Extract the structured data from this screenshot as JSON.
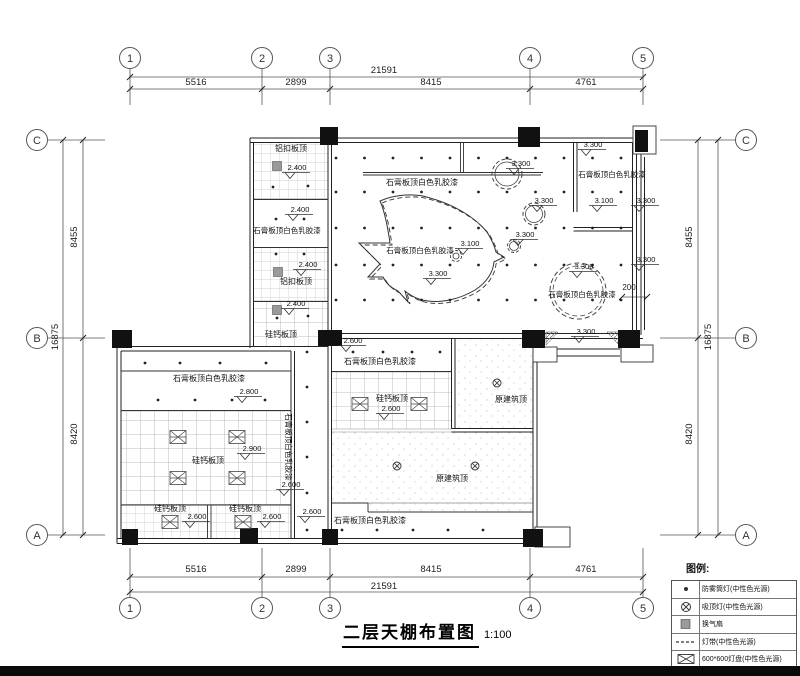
{
  "title": {
    "text": "二层天棚布置图",
    "scale": "1:100"
  },
  "legend": {
    "title": "图例:",
    "items": [
      {
        "symbol": "downlight-dot",
        "label": "防雾筒灯(中性色光源)"
      },
      {
        "symbol": "ceiling-lamp",
        "label": "吸顶灯(中性色光源)"
      },
      {
        "symbol": "exhaust-fan",
        "label": "换气扇"
      },
      {
        "symbol": "light-strip",
        "label": "灯带(中性色光源)"
      },
      {
        "symbol": "panel-light",
        "label": "600*600灯盘(中性色光源)"
      }
    ]
  },
  "grid": {
    "cols": [
      {
        "id": "1",
        "x": 130
      },
      {
        "id": "2",
        "x": 262
      },
      {
        "id": "3",
        "x": 330
      },
      {
        "id": "4",
        "x": 530
      },
      {
        "id": "5",
        "x": 643
      }
    ],
    "rows": [
      {
        "id": "C",
        "y": 140
      },
      {
        "id": "B",
        "y": 338
      },
      {
        "id": "A",
        "y": 535
      }
    ],
    "dims": [
      {
        "t": "21591",
        "x": 384,
        "y": 73
      },
      {
        "t": "5516",
        "x": 196,
        "y": 85
      },
      {
        "t": "2899",
        "x": 296,
        "y": 85
      },
      {
        "t": "8415",
        "x": 431,
        "y": 85
      },
      {
        "t": "4761",
        "x": 586,
        "y": 85
      },
      {
        "t": "5516",
        "x": 196,
        "y": 572
      },
      {
        "t": "2899",
        "x": 296,
        "y": 572
      },
      {
        "t": "8415",
        "x": 431,
        "y": 572
      },
      {
        "t": "4761",
        "x": 586,
        "y": 572
      },
      {
        "t": "21591",
        "x": 384,
        "y": 589
      },
      {
        "t": "8455",
        "x": 77,
        "y": 237,
        "r": -90
      },
      {
        "t": "8420",
        "x": 77,
        "y": 434,
        "r": -90
      },
      {
        "t": "16875",
        "x": 58,
        "y": 337,
        "r": -90
      },
      {
        "t": "8455",
        "x": 692,
        "y": 237,
        "r": -90
      },
      {
        "t": "8420",
        "x": 692,
        "y": 434,
        "r": -90
      },
      {
        "t": "16875",
        "x": 711,
        "y": 337,
        "r": -90
      },
      {
        "t": "200",
        "x": 629,
        "y": 290,
        "s": 8
      }
    ]
  },
  "plan": {
    "labels": [
      {
        "t": "铝扣板顶",
        "x": 291,
        "y": 151
      },
      {
        "t": "石膏板顶白色乳胶漆",
        "x": 287,
        "y": 233,
        "s": 7.5
      },
      {
        "t": "铝扣板顶",
        "x": 296,
        "y": 284
      },
      {
        "t": "硅钙板顶",
        "x": 281,
        "y": 337
      },
      {
        "t": "石膏板顶白色乳胶漆",
        "x": 422,
        "y": 185
      },
      {
        "t": "石膏板顶白色乳胶漆",
        "x": 420,
        "y": 253,
        "s": 7.5
      },
      {
        "t": "石膏板顶白色乳胶漆",
        "x": 612,
        "y": 177,
        "s": 7.5
      },
      {
        "t": "石膏板顶白色乳胶漆",
        "x": 582,
        "y": 297,
        "s": 7.5
      },
      {
        "t": "石膏板顶白色乳胶漆",
        "x": 209,
        "y": 381
      },
      {
        "t": "硅钙板顶",
        "x": 208,
        "y": 463
      },
      {
        "t": "石膏板顶白色乳胶漆",
        "x": 286,
        "y": 447,
        "r": 90,
        "s": 7.5
      },
      {
        "t": "硅钙板顶",
        "x": 170,
        "y": 511
      },
      {
        "t": "硅钙板顶",
        "x": 245,
        "y": 511
      },
      {
        "t": "石膏板顶白色乳胶漆",
        "x": 370,
        "y": 523
      },
      {
        "t": "石膏板顶白色乳胶漆",
        "x": 380,
        "y": 364
      },
      {
        "t": "硅钙板顶",
        "x": 392,
        "y": 401
      },
      {
        "t": "原建筑顶",
        "x": 511,
        "y": 402
      },
      {
        "t": "原建筑顶",
        "x": 452,
        "y": 481
      }
    ],
    "elevations": [
      {
        "v": "2.400",
        "x": 297,
        "y": 170
      },
      {
        "v": "2.400",
        "x": 300,
        "y": 212
      },
      {
        "v": "2.400",
        "x": 308,
        "y": 267
      },
      {
        "v": "2.400",
        "x": 296,
        "y": 306
      },
      {
        "v": "3.300",
        "x": 593,
        "y": 147
      },
      {
        "v": "3.100",
        "x": 604,
        "y": 203
      },
      {
        "v": "3.300",
        "x": 646,
        "y": 203
      },
      {
        "v": "3.300",
        "x": 521,
        "y": 166
      },
      {
        "v": "3.300",
        "x": 544,
        "y": 203
      },
      {
        "v": "3.300",
        "x": 525,
        "y": 237
      },
      {
        "v": "3.100",
        "x": 470,
        "y": 246
      },
      {
        "v": "3.300",
        "x": 438,
        "y": 276
      },
      {
        "v": "3.300",
        "x": 584,
        "y": 269
      },
      {
        "v": "3.300",
        "x": 646,
        "y": 262
      },
      {
        "v": "3.300",
        "x": 586,
        "y": 334
      },
      {
        "v": "2.600",
        "x": 353,
        "y": 343
      },
      {
        "v": "2.800",
        "x": 249,
        "y": 394
      },
      {
        "v": "2.900",
        "x": 252,
        "y": 451
      },
      {
        "v": "2.600",
        "x": 391,
        "y": 411
      },
      {
        "v": "2.600",
        "x": 291,
        "y": 487
      },
      {
        "v": "2.600",
        "x": 197,
        "y": 519
      },
      {
        "v": "2.600",
        "x": 272,
        "y": 519
      },
      {
        "v": "2.600",
        "x": 312,
        "y": 514
      }
    ],
    "downlights": {
      "grid": {
        "x0": 336,
        "dx": 28.5,
        "nx": 11,
        "rows": [
          158,
          192,
          228,
          265,
          300
        ]
      },
      "points": [
        [
          273,
          187
        ],
        [
          308,
          186
        ],
        [
          276,
          219
        ],
        [
          304,
          219
        ],
        [
          276,
          254
        ],
        [
          304,
          254
        ],
        [
          277,
          318
        ],
        [
          308,
          316
        ],
        [
          145,
          363
        ],
        [
          180,
          363
        ],
        [
          220,
          363
        ],
        [
          266,
          363
        ],
        [
          158,
          400
        ],
        [
          195,
          400
        ],
        [
          232,
          400
        ],
        [
          265,
          400
        ],
        [
          307,
          352
        ],
        [
          307,
          387
        ],
        [
          307,
          422
        ],
        [
          307,
          457
        ],
        [
          307,
          493
        ],
        [
          307,
          530
        ],
        [
          353,
          352
        ],
        [
          383,
          352
        ],
        [
          412,
          352
        ],
        [
          440,
          352
        ],
        [
          342,
          530
        ],
        [
          377,
          530
        ],
        [
          413,
          530
        ],
        [
          448,
          530
        ],
        [
          483,
          530
        ]
      ]
    },
    "ceiling_lamps": [
      [
        497,
        383
      ],
      [
        397,
        466
      ],
      [
        475,
        466
      ]
    ],
    "fans": [
      [
        277,
        166
      ],
      [
        278,
        272
      ],
      [
        277,
        310
      ]
    ],
    "panel_lights": [
      [
        178,
        437
      ],
      [
        237,
        437
      ],
      [
        178,
        478
      ],
      [
        237,
        478
      ],
      [
        170,
        522
      ],
      [
        243,
        522
      ],
      [
        360,
        404
      ],
      [
        419,
        404
      ]
    ]
  },
  "colors": {
    "line": "#222",
    "text": "#111",
    "fan_fill": "#9a9a9a",
    "grid_line": "#bbbbbb"
  }
}
